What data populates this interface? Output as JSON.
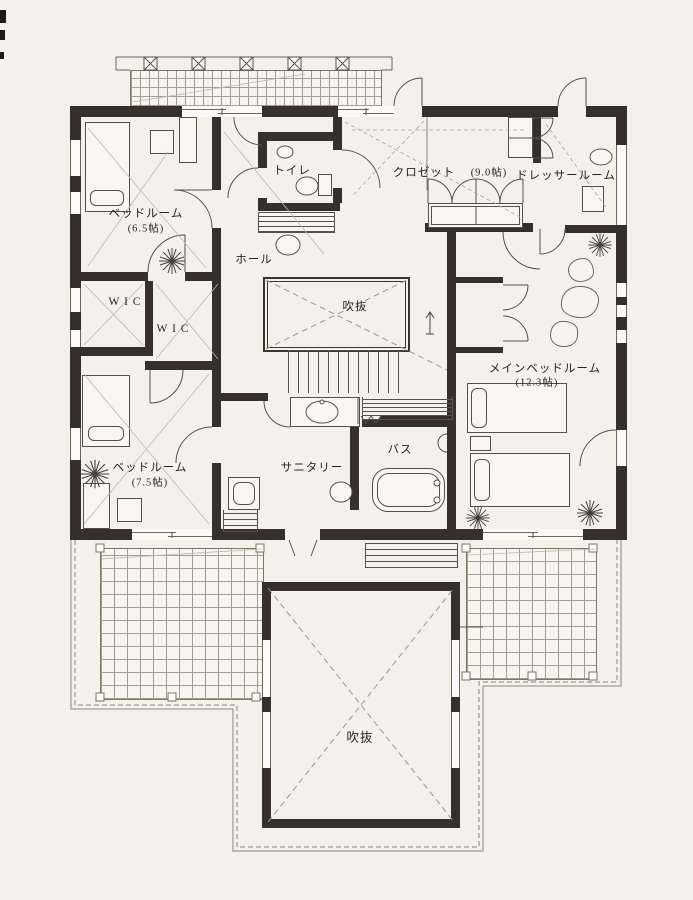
{
  "document": {
    "type": "floor-plan"
  },
  "rooms": {
    "bedroom1": {
      "name": "ベッドルーム",
      "size": "(6.5帖)"
    },
    "wic1": {
      "name": "W I C"
    },
    "wic2": {
      "name": "W I C"
    },
    "toilet": {
      "name": "トイレ"
    },
    "hall": {
      "name": "ホール"
    },
    "closet": {
      "name": "クロゼット",
      "size": "(9.0帖)"
    },
    "dresser": {
      "name": "ドレッサールーム"
    },
    "void_upper": {
      "name": "吹抜"
    },
    "main_bedroom": {
      "name": "メインベッドルーム",
      "size": "(12.3帖)"
    },
    "bedroom2": {
      "name": "ベッドルーム",
      "size": "(7.5帖)"
    },
    "sanitary": {
      "name": "サニタリー"
    },
    "bath": {
      "name": "バス"
    },
    "void_lower": {
      "name": "吹抜"
    }
  },
  "colors": {
    "wall": "#35302a",
    "paper": "#f4f1ea",
    "line": "#55504a",
    "grid": "#a49e91"
  }
}
